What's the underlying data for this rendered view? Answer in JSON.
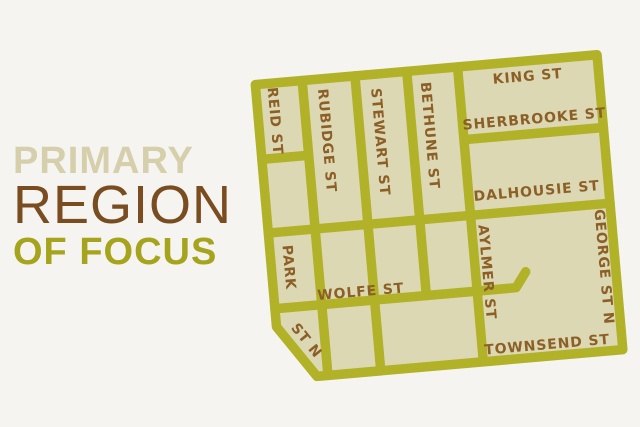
{
  "title": {
    "line1": "PRIMARY",
    "line2": "REGION",
    "line3": "OF FOCUS"
  },
  "map": {
    "labels": {
      "king": "KING ST",
      "sherbrooke": "SHERBROOKE ST",
      "dalhousie": "DALHOUSIE ST",
      "wolfe": "WOLFE ST",
      "townsend": "TOWNSEND ST",
      "reid": "REID ST",
      "rubidge": "RUBIDGE ST",
      "stewart": "STEWART ST",
      "bethune": "BETHUNE ST",
      "park": "PARK",
      "park_continued": "ST N",
      "aylmer": "AYLMER ST",
      "george": "GEORGE ST N"
    }
  },
  "colors": {
    "street_olive": "#b1b228",
    "block_beige": "#ddd8b4",
    "label_brown": "#8b5f26",
    "title_primary_beige": "#d5cfac",
    "title_region_brown": "#7a4d20",
    "title_focus_olive": "#a5a41c",
    "background": "#f5f4f1"
  }
}
